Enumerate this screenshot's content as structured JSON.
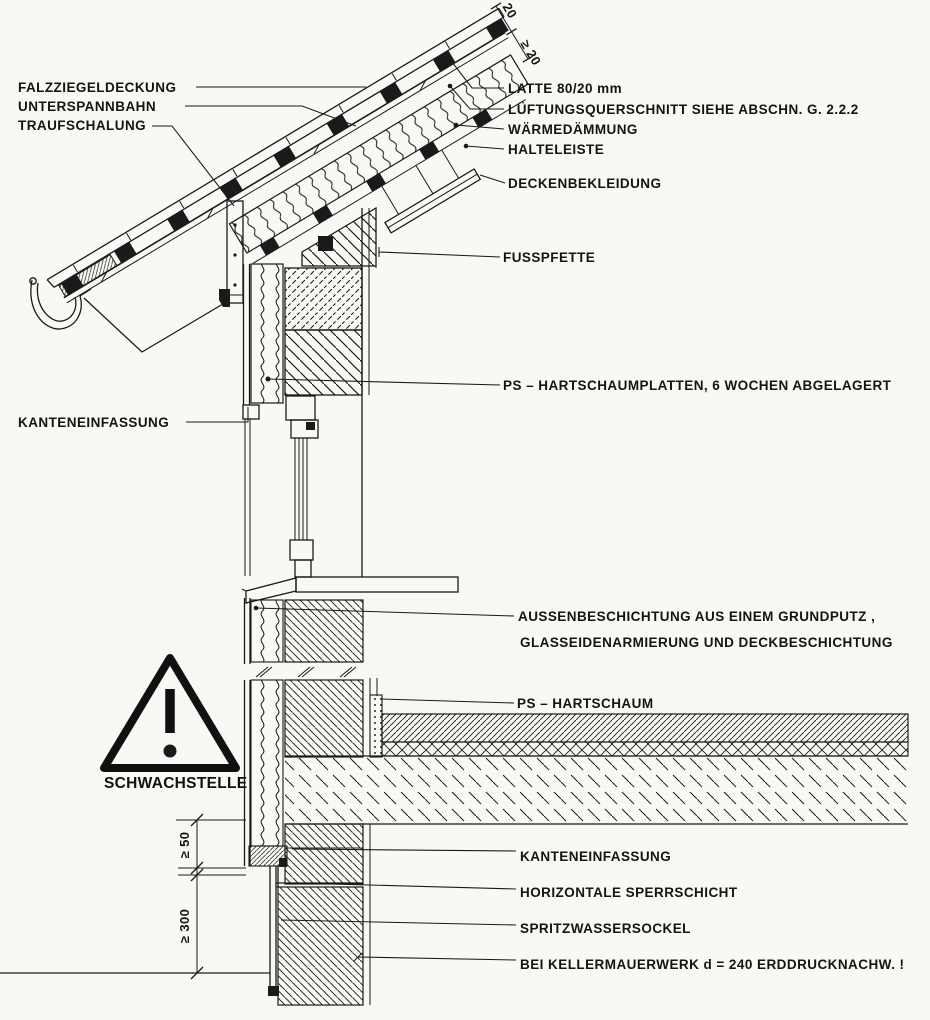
{
  "colors": {
    "ink": "#1a1a1a",
    "paper": "#faf8f4"
  },
  "labels": {
    "falzziegeldeckung": "FALZZIEGELDECKUNG",
    "unterspannbahn": "UNTERSPANNBAHN",
    "traufschalung": "TRAUFSCHALUNG",
    "latte": "LATTE 80/20 mm",
    "lueftungsquerschnitt": "LÜFTUNGSQUERSCHNITT SIEHE ABSCHN. G. 2.2.2",
    "waermedaemmung": "WÄRMEDÄMMUNG",
    "halteleiste": "HALTELEISTE",
    "deckenbekleidung": "DECKENBEKLEIDUNG",
    "fusspfette": "FUSSPFETTE",
    "ps_hartschaumplatten": "PS – HARTSCHAUMPLATTEN, 6 WOCHEN ABGELAGERT",
    "kanteneinfassung_oben": "KANTENEINFASSUNG",
    "aussenbeschichtung_zeile1": "AUSSENBESCHICHTUNG AUS EINEM GRUNDPUTZ ,",
    "aussenbeschichtung_zeile2": "GLASSEIDENARMIERUNG UND DECKBESCHICHTUNG",
    "ps_hartschaum": "PS – HARTSCHAUM",
    "kanteneinfassung_unten": "KANTENEINFASSUNG",
    "horizontale_sperrschicht": "HORIZONTALE SPERRSCHICHT",
    "spritzwassersockel": "SPRITZWASSERSOCKEL",
    "kellermauerwerk": "BEI KELLERMAUERWERK d = 240 ERDDRUCKNACHW. !"
  },
  "warning": {
    "symbol": "exclamation-triangle",
    "text": "SCHWACHSTELLE"
  },
  "dimensions": {
    "konterlatte": "20",
    "lueftung_min": "≥ 20",
    "sockel_ueberstand": "≥ 50",
    "spritzwasser_hoehe": "≥ 300"
  }
}
